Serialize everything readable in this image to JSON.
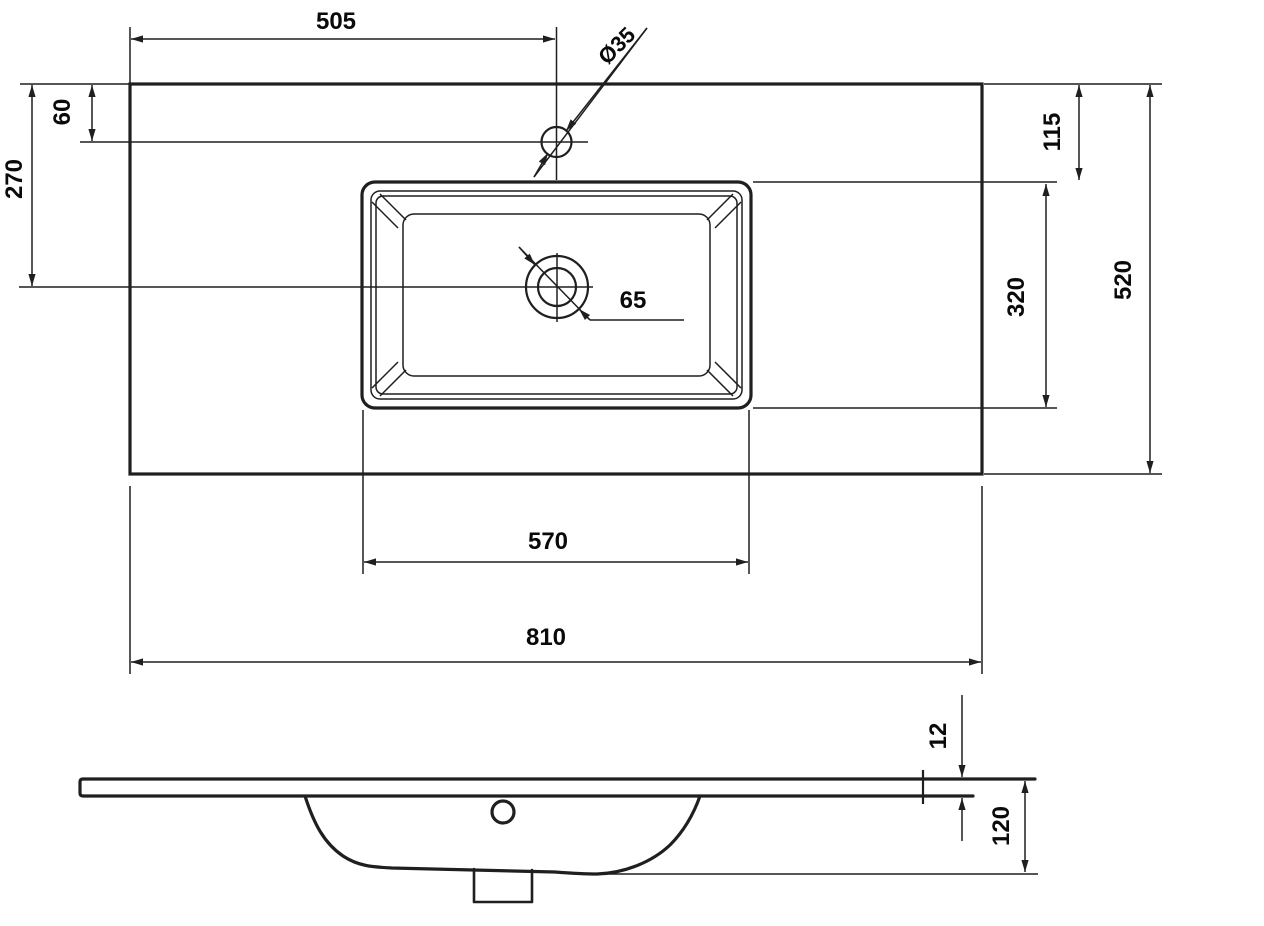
{
  "drawing": {
    "kind": "washbasin technical dimension drawing",
    "colors": {
      "background": "#ffffff",
      "line": "#1f1f1f",
      "text": "#0a0a0a"
    },
    "dims": {
      "faucet_from_left": "505",
      "faucet_hole_diameter": "Ø35",
      "faucet_from_back_edge": "60",
      "drain_from_back_edge": "270",
      "basin_rim_from_back_edge": "115",
      "countertop_depth": "520",
      "basin_outer_depth": "320",
      "drain_diameter": "65",
      "basin_outer_width": "570",
      "countertop_width": "810",
      "slab_thickness": "12",
      "basin_height": "120"
    }
  }
}
